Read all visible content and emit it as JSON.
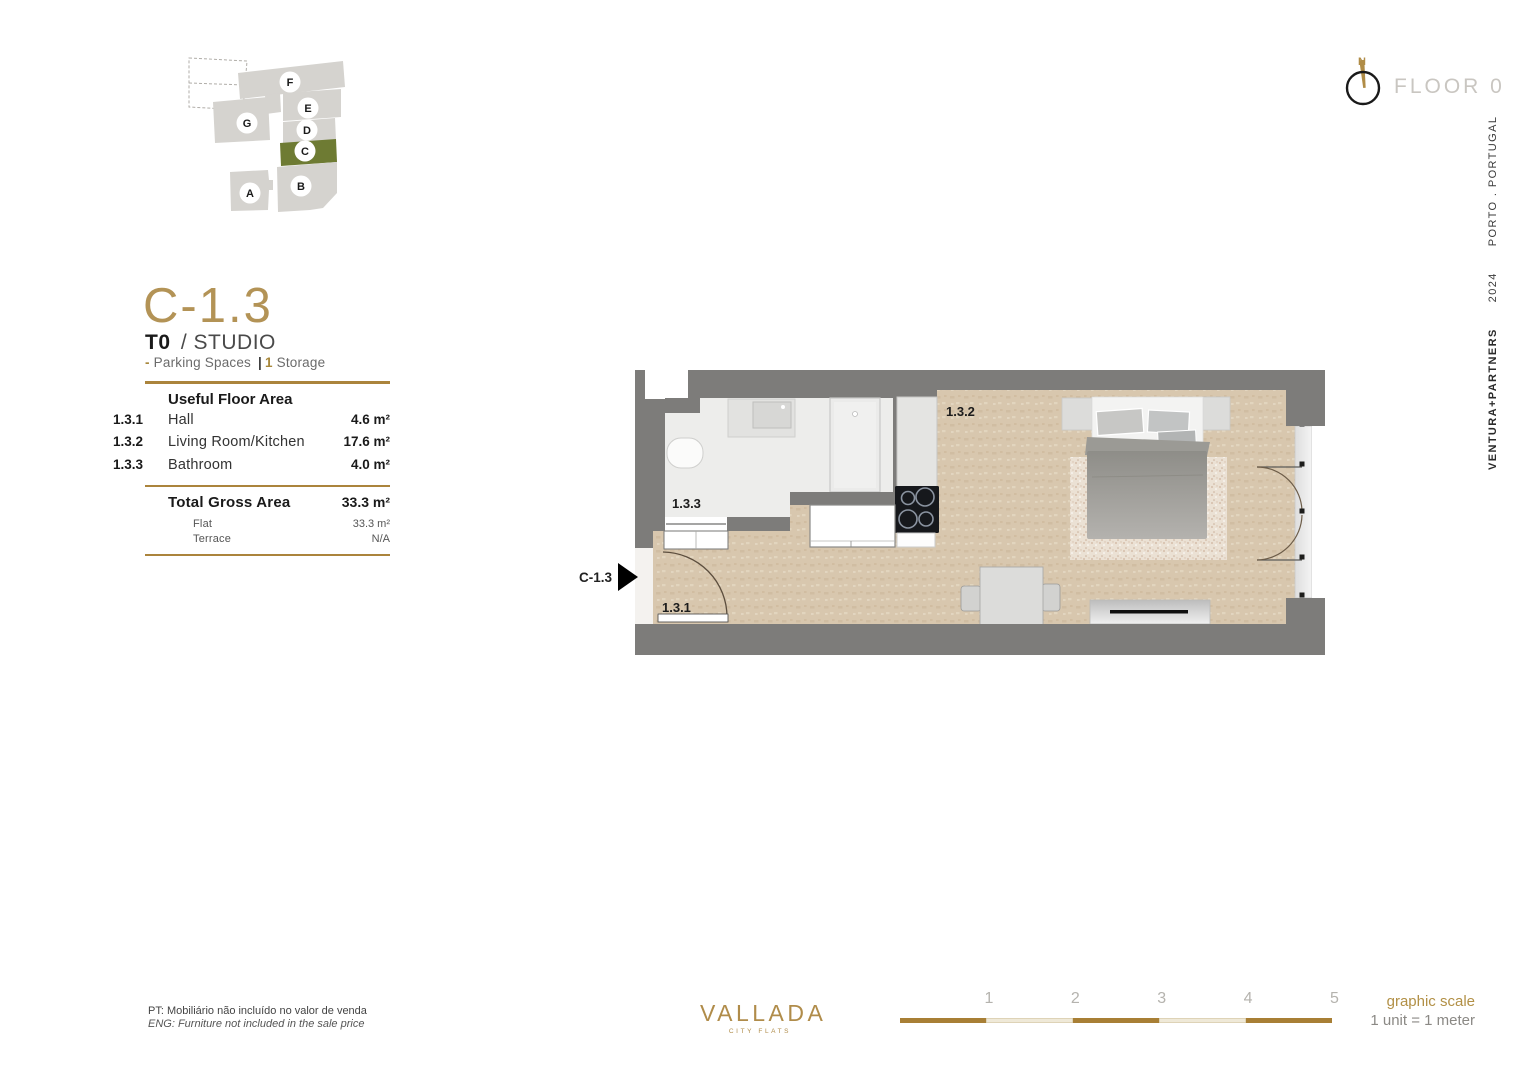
{
  "unit": {
    "code": "C-1.3",
    "type_bold": "T0",
    "type_rest": "/ STUDIO",
    "features_dash": "-",
    "features_parking": "Parking Spaces",
    "features_sep": "|",
    "features_storage_count": "1",
    "features_storage": "Storage"
  },
  "site_plan": {
    "blocks": [
      {
        "label": "A"
      },
      {
        "label": "B"
      },
      {
        "label": "C"
      },
      {
        "label": "D"
      },
      {
        "label": "E"
      },
      {
        "label": "F"
      },
      {
        "label": "G"
      }
    ],
    "highlighted_block": "C"
  },
  "header": {
    "north_label": "N",
    "floor_label": "FLOOR 0"
  },
  "side_text": {
    "brand": "VENTURA+PARTNERS",
    "year": "2024",
    "location": "PORTO . PORTUGAL"
  },
  "area_table": {
    "title": "Useful Floor Area",
    "rows": [
      {
        "code": "1.3.1",
        "name": "Hall",
        "value": "4.6 m²"
      },
      {
        "code": "1.3.2",
        "name": "Living Room/Kitchen",
        "value": "17.6 m²"
      },
      {
        "code": "1.3.3",
        "name": "Bathroom",
        "value": "4.0 m²"
      }
    ],
    "total_label": "Total Gross Area",
    "total_value": "33.3 m²",
    "sub_rows": [
      {
        "name": "Flat",
        "value": "33.3 m²"
      },
      {
        "name": "Terrace",
        "value": "N/A"
      }
    ]
  },
  "floor_plan": {
    "entrance_label": "C-1.3",
    "room_labels": [
      {
        "id": "1.3.1"
      },
      {
        "id": "1.3.2"
      },
      {
        "id": "1.3.3"
      }
    ]
  },
  "footer": {
    "note_pt": "PT: Mobiliário não incluído no valor de venda",
    "note_en": "ENG: Furniture not included in the sale price",
    "logo_word": "VALLADA",
    "logo_sub": "CITY FLATS",
    "scale_ticks": [
      "1",
      "2",
      "3",
      "4",
      "5"
    ],
    "scale_title": "graphic scale",
    "scale_sub": "1 unit = 1 meter"
  },
  "colors": {
    "gold": "#ab843c",
    "gold_light": "#b29046",
    "olive_highlight": "#6e7b33",
    "site_block_gray": "#d5d3cf",
    "wall_gray": "#7d7c7a",
    "floor_beige": "#d8c7ae",
    "bathroom_floor": "#ededeb"
  }
}
